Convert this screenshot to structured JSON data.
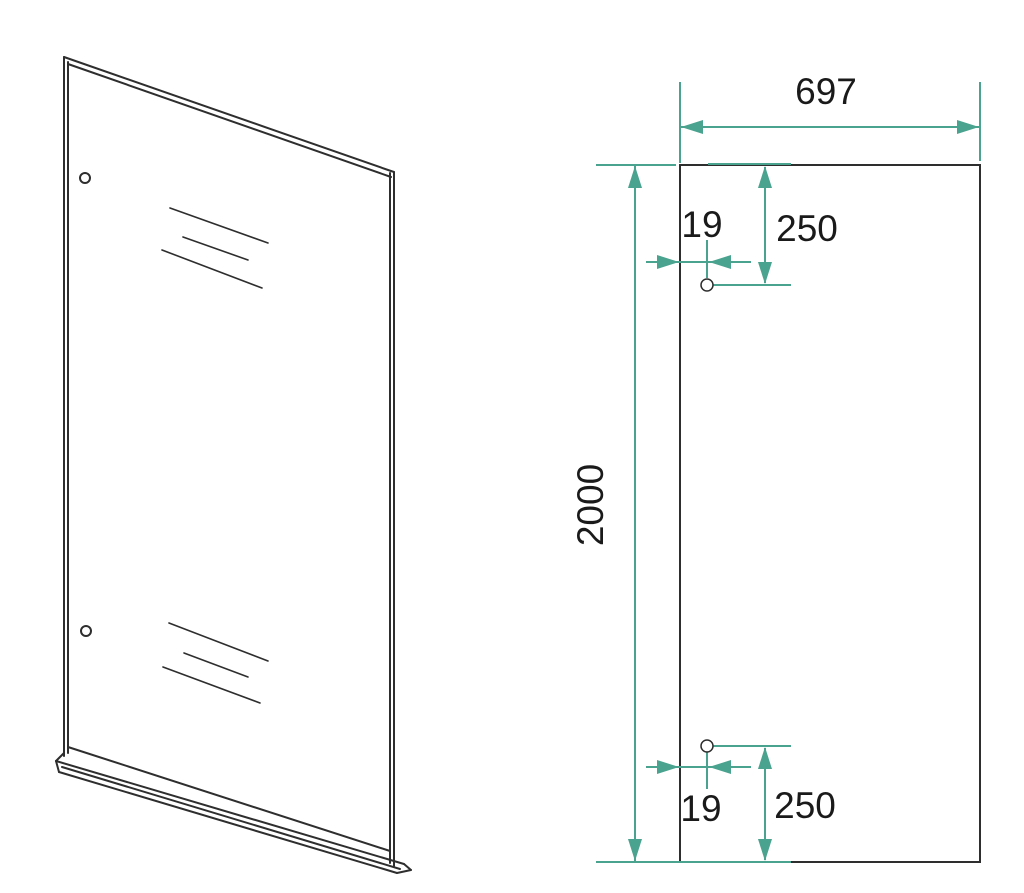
{
  "drawing": {
    "dimensions": {
      "panel_width": "697",
      "panel_height": "2000",
      "hole_top_inset": "19",
      "hole_top_drop": "250",
      "hole_bottom_inset": "19",
      "hole_bottom_rise": "250"
    },
    "colors": {
      "outline": "#2e2e2e",
      "dimension": "#4AA38F",
      "text": "#1a1a1a",
      "background": "#ffffff"
    }
  }
}
